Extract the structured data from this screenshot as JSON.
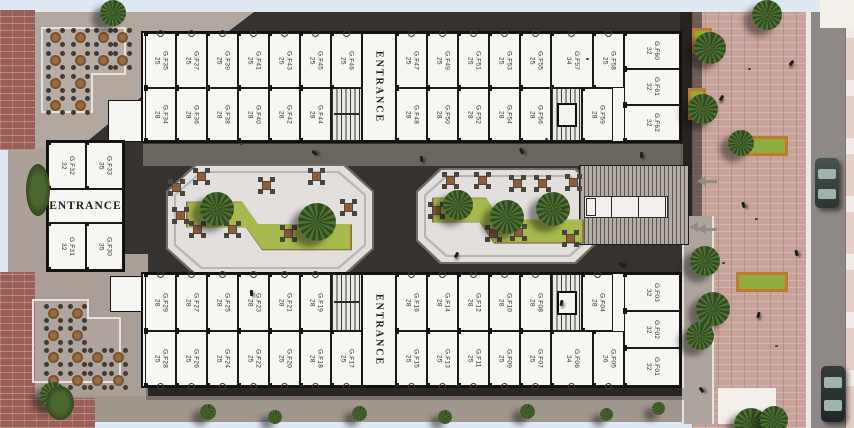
{
  "plan": {
    "left_entrance": "ENTRANCE",
    "wings": {
      "top_outer": [
        {
          "type": "unit",
          "name": "G.F35",
          "area": "25"
        },
        {
          "type": "unit",
          "name": "G.F37",
          "area": "25"
        },
        {
          "type": "unit",
          "name": "G.F39",
          "area": "25"
        },
        {
          "type": "unit",
          "name": "G.F41",
          "area": "25"
        },
        {
          "type": "unit",
          "name": "G.F43",
          "area": "25"
        },
        {
          "type": "unit",
          "name": "G.F45",
          "area": "25"
        },
        {
          "type": "unit",
          "name": "G.F46",
          "area": "25"
        },
        {
          "type": "entrance",
          "label": "ENTRANCE"
        },
        {
          "type": "unit",
          "name": "G.F47",
          "area": "25"
        },
        {
          "type": "unit",
          "name": "G.F49",
          "area": "25"
        },
        {
          "type": "unit",
          "name": "G.F51",
          "area": "25"
        },
        {
          "type": "unit",
          "name": "G.F53",
          "area": "25"
        },
        {
          "type": "unit",
          "name": "G.F55",
          "area": "25"
        },
        {
          "type": "unit",
          "name": "G.F57",
          "area": "34"
        },
        {
          "type": "unit",
          "name": "G.F58",
          "area": "25"
        }
      ],
      "top_inner": [
        {
          "type": "unit",
          "name": "G.F34",
          "area": "28"
        },
        {
          "type": "unit",
          "name": "G.F36",
          "area": "28"
        },
        {
          "type": "unit",
          "name": "G.F38",
          "area": "28"
        },
        {
          "type": "unit",
          "name": "G.F40",
          "area": "28"
        },
        {
          "type": "unit",
          "name": "G.F42",
          "area": "28"
        },
        {
          "type": "unit",
          "name": "G.F44",
          "area": "28"
        },
        {
          "type": "stairs"
        },
        {
          "type": "void"
        },
        {
          "type": "unit",
          "name": "G.F48",
          "area": "28"
        },
        {
          "type": "unit",
          "name": "G.F50",
          "area": "28"
        },
        {
          "type": "unit",
          "name": "G.F52",
          "area": "28"
        },
        {
          "type": "unit",
          "name": "G.F54",
          "area": "28"
        },
        {
          "type": "unit",
          "name": "G.F56",
          "area": "28"
        },
        {
          "type": "stairs-elevator"
        },
        {
          "type": "unit",
          "name": "G.F59",
          "area": "28"
        }
      ],
      "top_right": [
        {
          "type": "unit",
          "name": "G.F60",
          "area": "32"
        },
        {
          "type": "unit",
          "name": "G.F61",
          "area": "32"
        },
        {
          "type": "unit",
          "name": "G.F62",
          "area": "32"
        }
      ],
      "left_top": [
        {
          "type": "unit",
          "name": "G.F32",
          "area": "32"
        },
        {
          "type": "unit",
          "name": "G.F33",
          "area": "35"
        }
      ],
      "left_bottom": [
        {
          "type": "unit",
          "name": "G.F31",
          "area": "32"
        },
        {
          "type": "unit",
          "name": "G.F30",
          "area": "35"
        }
      ],
      "bottom_inner": [
        {
          "type": "unit",
          "name": "G.F29",
          "area": "28"
        },
        {
          "type": "unit",
          "name": "G.F27",
          "area": "28"
        },
        {
          "type": "unit",
          "name": "G.F25",
          "area": "28"
        },
        {
          "type": "unit",
          "name": "G.F23",
          "area": "28"
        },
        {
          "type": "unit",
          "name": "G.F21",
          "area": "28"
        },
        {
          "type": "unit",
          "name": "G.F19",
          "area": "28"
        },
        {
          "type": "stairs"
        },
        {
          "type": "void"
        },
        {
          "type": "unit",
          "name": "G.F16",
          "area": "28"
        },
        {
          "type": "unit",
          "name": "G.F14",
          "area": "28"
        },
        {
          "type": "unit",
          "name": "G.F12",
          "area": "28"
        },
        {
          "type": "unit",
          "name": "G.F10",
          "area": "28"
        },
        {
          "type": "unit",
          "name": "G.F08",
          "area": "28"
        },
        {
          "type": "stairs-elevator"
        },
        {
          "type": "unit",
          "name": "G.F04",
          "area": "28"
        }
      ],
      "bottom_outer": [
        {
          "type": "unit",
          "name": "G.F28",
          "area": "25"
        },
        {
          "type": "unit",
          "name": "G.F26",
          "area": "25"
        },
        {
          "type": "unit",
          "name": "G.F24",
          "area": "25"
        },
        {
          "type": "unit",
          "name": "G.F22",
          "area": "25"
        },
        {
          "type": "unit",
          "name": "G.F20",
          "area": "25"
        },
        {
          "type": "unit",
          "name": "G.F18",
          "area": "28"
        },
        {
          "type": "unit",
          "name": "G.F17",
          "area": "25"
        },
        {
          "type": "entrance",
          "label": "ENTRANCE"
        },
        {
          "type": "unit",
          "name": "G.F15",
          "area": "25"
        },
        {
          "type": "unit",
          "name": "G.F13",
          "area": "25"
        },
        {
          "type": "unit",
          "name": "G.F11",
          "area": "25"
        },
        {
          "type": "unit",
          "name": "G.F09",
          "area": "25"
        },
        {
          "type": "unit",
          "name": "G.F07",
          "area": "25"
        },
        {
          "type": "unit",
          "name": "G.F06",
          "area": "34"
        },
        {
          "type": "unit",
          "name": "G.F05",
          "area": "26"
        }
      ],
      "bottom_right": [
        {
          "type": "unit",
          "name": "G.F03",
          "area": "32"
        },
        {
          "type": "unit",
          "name": "G.F02",
          "area": "32"
        },
        {
          "type": "unit",
          "name": "G.F01",
          "area": "32"
        }
      ]
    },
    "colors": {
      "unit_fill": "#f8f6f3",
      "wall": "#101010",
      "lawn_green": "#a6ba4d",
      "lawn_border": "#8f6b3e",
      "plaza_dark": "#36322f",
      "plaza_brick": "#c7a29a",
      "planter_orange": "#c07a30"
    }
  }
}
